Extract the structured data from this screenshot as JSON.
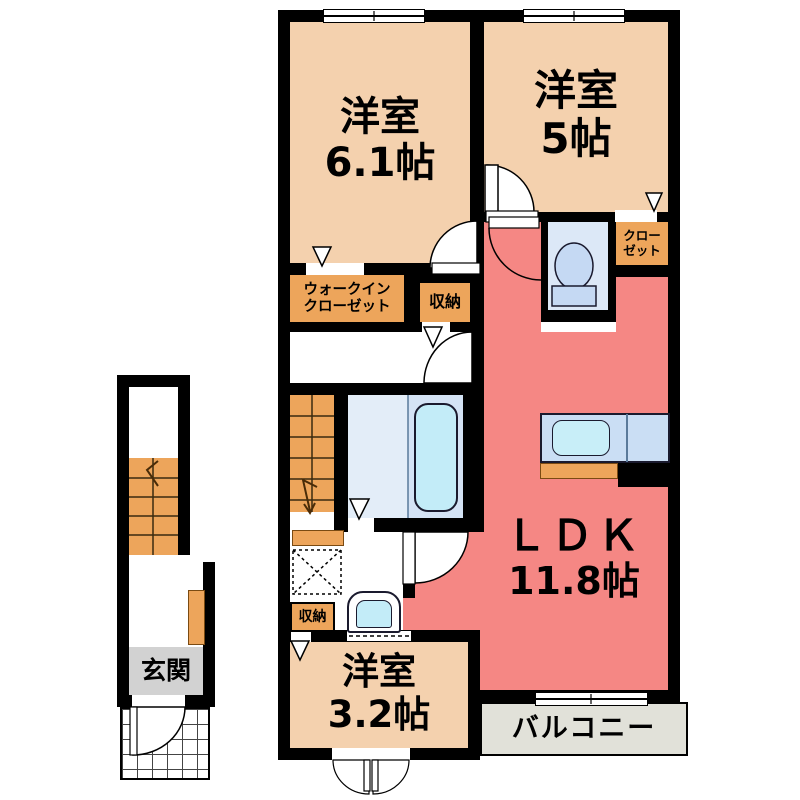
{
  "title": "apartment-floor-plan",
  "rooms": {
    "western_6_1": {
      "name": "洋室",
      "size": "6.1帖",
      "color": "#f4d1ae"
    },
    "western_5": {
      "name": "洋室",
      "size": "5帖",
      "color": "#f4d1ae"
    },
    "ldk": {
      "name": "ＬＤＫ",
      "size": "11.8帖",
      "color": "#f58784"
    },
    "western_3_2": {
      "name": "洋室",
      "size": "3.2帖",
      "color": "#f4d1ae"
    },
    "walk_in_closet": {
      "line1": "ウォークイン",
      "line2": "クローゼット",
      "color": "#eda55b"
    },
    "closet": {
      "line1": "クロー",
      "line2": "ゼット",
      "color": "#eda55b"
    },
    "storage_hall": {
      "name": "収納",
      "color": "#eda55b"
    },
    "storage_wash": {
      "name": "収納",
      "color": "#eda55b"
    },
    "balcony": {
      "name": "バルコニー",
      "color": "#e1e1d9"
    },
    "entrance": {
      "name": "玄関",
      "color": "#d2d2d2"
    }
  },
  "fixtures": {
    "bathtub": "bathtub",
    "toilet": "toilet",
    "kitchen_sink": "kitchen-sink",
    "washbasin": "washbasin",
    "washing_machine_space": "washing-machine-space",
    "stairs_unit": "stairs",
    "stairs_entrance": "stairs"
  },
  "colors": {
    "wall": "#000000",
    "bedroom": "#f4d1ae",
    "ldk": "#f58784",
    "storage": "#eda55b",
    "bath_left": "#e3edf8",
    "bath_right": "#d4e3f5",
    "tub": "#c3ecf8",
    "toilet_room": "#dce8f7",
    "fixture_blue": "#c5d9f3",
    "kitchen_counter": "#cadef4",
    "sink": "#c8eef8",
    "entrance_gray": "#d2d2d2",
    "balcony_gray": "#e1e1d9"
  }
}
